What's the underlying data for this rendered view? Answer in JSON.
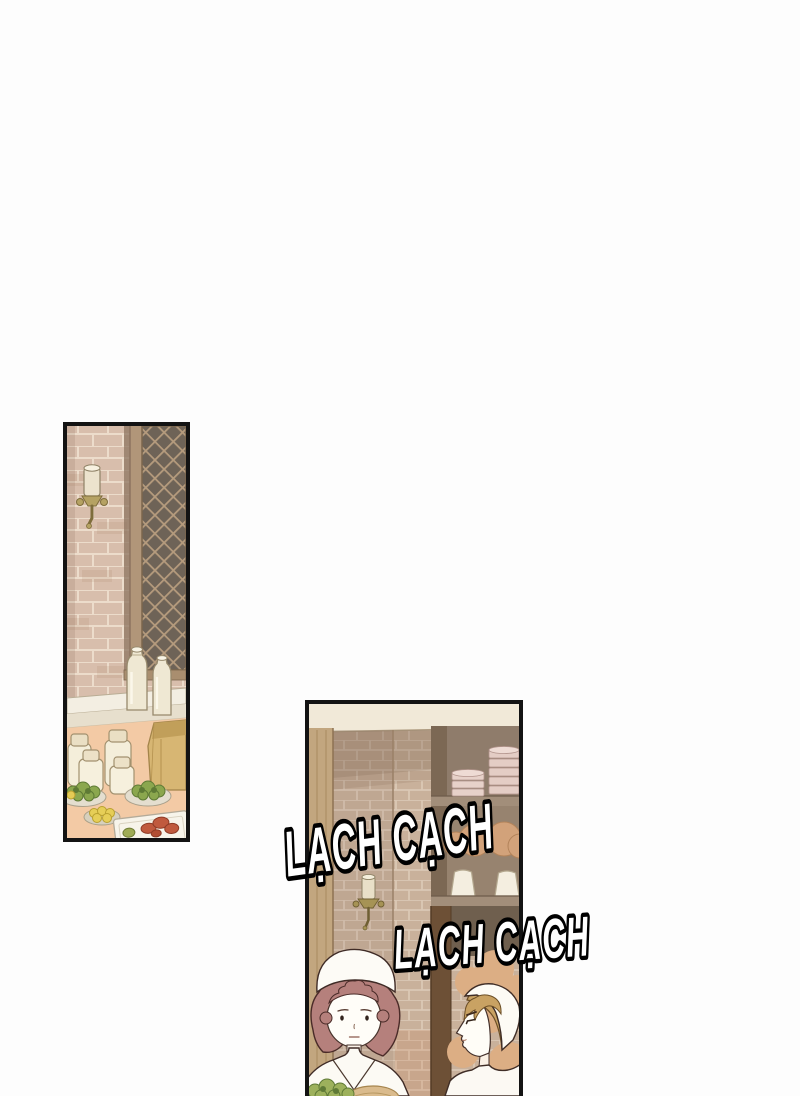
{
  "page": {
    "background_color": "#ffffff",
    "kind": "comic page with two panels"
  },
  "sfx": {
    "first": "LẠCH CẠCH",
    "second": "LẠCH CẠCH"
  },
  "palette": {
    "panel_border": "#131313",
    "sfx_fill": "#ffffff",
    "sfx_outline": "#000000",
    "brick_left_panel": "#d8beac",
    "brick_right_panel": "#c9b19b",
    "lattice_dark": "#6e6357",
    "wood_tan": "#c2a67f",
    "table_peach": "#f3caa5",
    "cream_bottle": "#efe8d3",
    "hair_left_maid": "#b5807c",
    "hair_right_maid": "#c9a263",
    "greens": "#9db15c",
    "bread_tan": "#dcae84"
  }
}
